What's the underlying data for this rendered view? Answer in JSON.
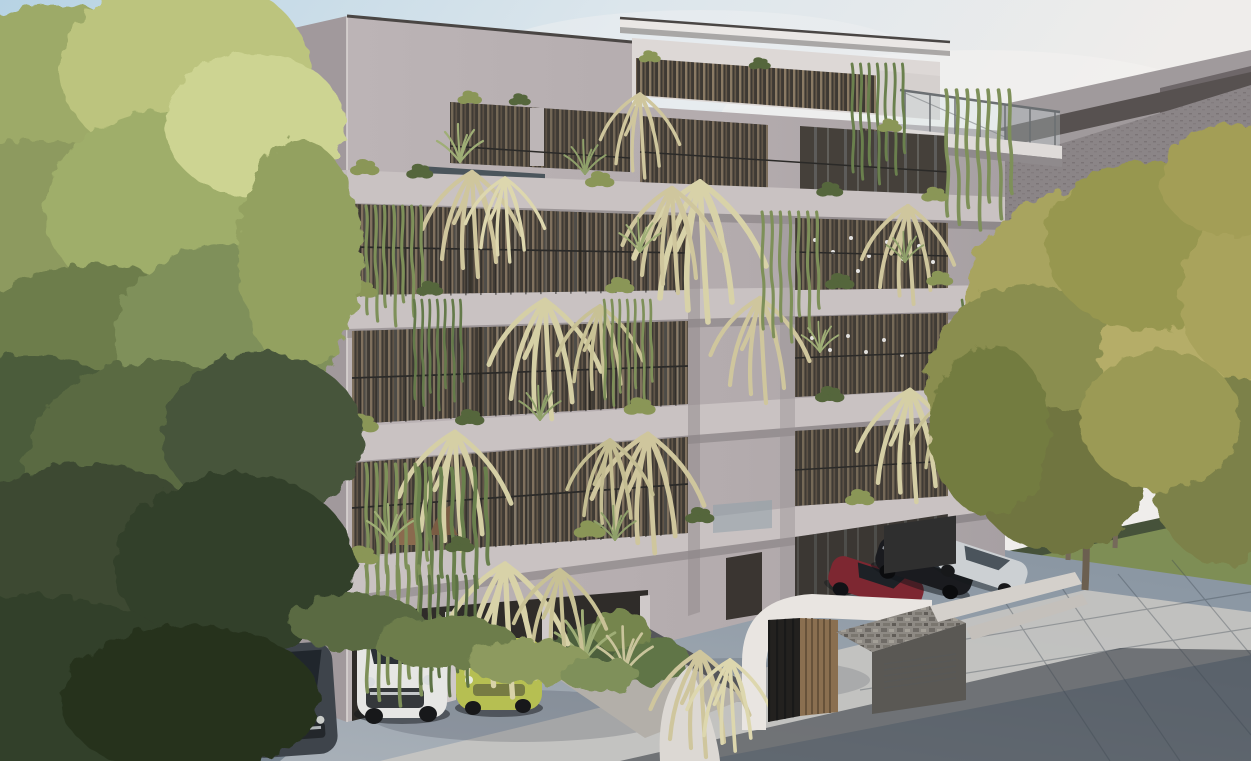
{
  "meta": {
    "kind": "architectural-exterior-rendering",
    "subject": "Modern five-storey apartment building with rooftop penthouse, cascading balcony plants, carport, basement garage ramp and street-side parking",
    "time_of_day": "daytime"
  },
  "palette": {
    "sky_top": "#b7d3e4",
    "sky_mid": "#dce6ec",
    "sky_right": "#efedeb",
    "wall_front": "#b6aeb0",
    "wall_front_dark": "#a49c9f",
    "wall_side": "#a1999c",
    "slab": "#c9c2c2",
    "slab_bright": "#d7d1d0",
    "roof_slab": "#eae7e5",
    "penthouse_white": "#ddd8d6",
    "opening_dark": "#453f39",
    "wood_slat": "#8a7a64",
    "glass_glint": "#9aa7ac",
    "rail_dark": "#2b2a28",
    "trough": "#4b555c",
    "plant_olive": "#8a9657",
    "plant_pale": "#cfc69d",
    "plant_green": "#6d7f4c",
    "plant_dark": "#4c5c3a",
    "vine_green": "#7e9059",
    "tree_light": "#c3cc8a",
    "tree_mid": "#9daa67",
    "tree_dark": "#55663f",
    "tree_deep": "#32402a",
    "tree_gold": "#a8a45e",
    "tree_olive": "#8a8e4f",
    "lawn": "#7c8c58",
    "lawn_light": "#b9c184",
    "hedge": "#46523a",
    "street": "#474e54",
    "pavement": "#97a2ad",
    "pavement_light": "#c6c5c2",
    "pavement_dark": "#2c3238",
    "fence_white": "#d8d5d0",
    "neighbor_roof": "#8b8587",
    "neighbor_upper": "#a09a9c",
    "neighbor_fascia": "#575150",
    "entrance_white": "#e9e5e1",
    "wood_door": "#8a6f50",
    "stone": "#a8a49c",
    "louver": "#2f2f2f",
    "car_white": "#e6e6e4",
    "car_green": "#b6bf52",
    "car_gray": "#3e444b",
    "car_red": "#7d2731",
    "car_black": "#1a1b1f",
    "car_silver": "#ccd0d3"
  },
  "scene": {
    "background": [
      "sky",
      "neighbor building sloped roof (right)",
      "sunlit lawn and garden wall (left)",
      "side street with white balustrade (left)"
    ],
    "building": {
      "storeys_visible": 5,
      "rooftop": [
        "penthouse with wood slats",
        "roof slab",
        "glass balustrade terrace (right)"
      ],
      "facade": [
        "continuous balcony slabs with rounded left corners",
        "floor-to-ceiling glazing with wooden slat screens",
        "thin black railings",
        "hanging ferns and vines",
        "planter troughs"
      ],
      "ground_floor": [
        "carport with parked cars",
        "stone-edged planter",
        "arched white entrance canopy",
        "wood-slat entry wall",
        "gate bars",
        "stone garage box with louver vent",
        "basement ramp walls"
      ]
    },
    "vehicles": [
      {
        "name": "dark-gray-hatchback",
        "location": "left driveway"
      },
      {
        "name": "white-suv",
        "location": "carport bay 1"
      },
      {
        "name": "green-compact",
        "location": "carport bay 2"
      },
      {
        "name": "burgundy-sedan",
        "location": "right parking"
      },
      {
        "name": "black-coupe",
        "location": "right parking"
      },
      {
        "name": "silver-sedan",
        "location": "right parking"
      }
    ],
    "vegetation": [
      "large yellow-green tree (left)",
      "golden olive trees (right verge)",
      "balcony ferns, vines, agaves, bushes",
      "front planter grasses"
    ],
    "ground": [
      "blue-gray parking apron",
      "sunlit concrete sidewalk with tile seams",
      "shadowed dark pavement (bottom right)",
      "grass verge (right)"
    ]
  }
}
